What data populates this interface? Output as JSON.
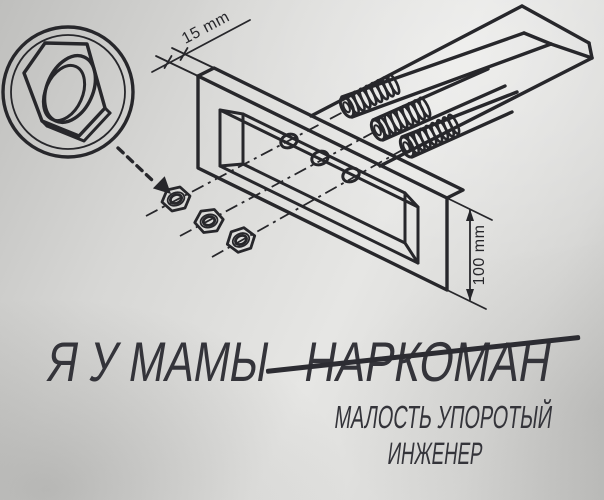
{
  "drawing": {
    "depth_label": "15 mm",
    "height_label": "100 mm"
  },
  "caption": {
    "line1_prefix": "Я У МАМЫ",
    "line1_struck": "НАРКОМАН",
    "line2": "МАЛОСТЬ УПОРОТЫЙ",
    "line3": "ИНЖЕНЕР"
  },
  "colors": {
    "ink": "#27272b",
    "caption_text": "#34343a",
    "strike": "#2c2c32",
    "paper_light": "#e6e6e4",
    "paper_mid": "#d7d7d5",
    "paper_dark": "#bfbfbd"
  }
}
